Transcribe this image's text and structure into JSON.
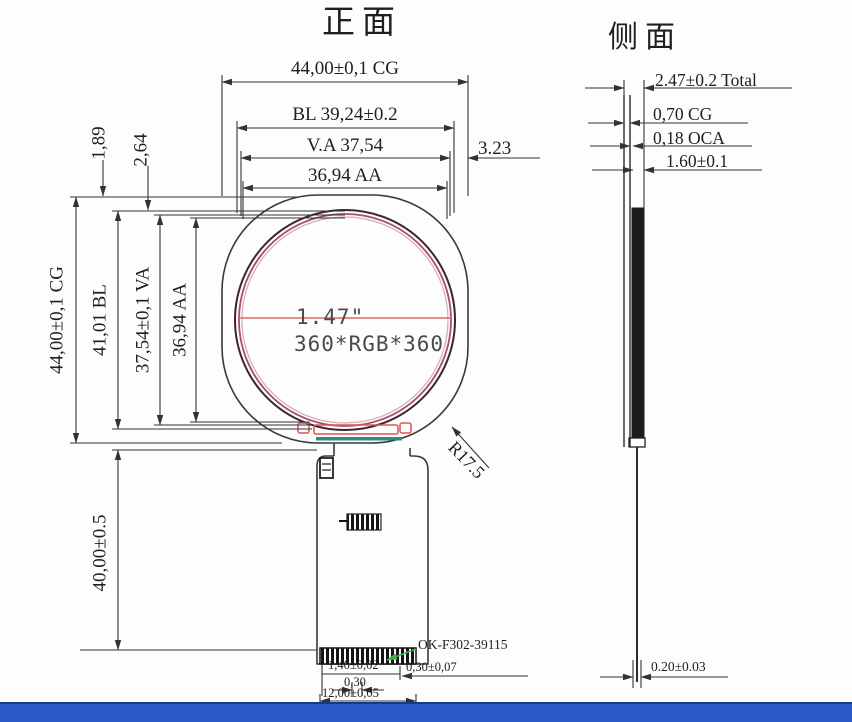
{
  "front": {
    "title": "正面",
    "dims_top": {
      "cg": "44,00±0,1 CG",
      "bl": "BL 39,24±0.2",
      "va": "V.A 37,54",
      "aa": "36,94 AA",
      "margin": "3.23"
    },
    "dims_left": {
      "cg": "44,00±0,1 CG",
      "bl": "41,01 BL",
      "va": "37,54±0,1 VA",
      "aa": "36,94 AA",
      "gap1": "1,89",
      "gap2": "2,64",
      "fpc_length": "40,00±0.5"
    },
    "corner_radius": "R17.5",
    "screen": {
      "size": "1.47\"",
      "resolution": "360*RGB*360"
    },
    "tail": {
      "part_number": "OK-F302-39115",
      "dim_pad": "1,40±0,02",
      "dim_pad_offset": "0,30±0,07",
      "dim_pitch": "0,30",
      "dim_width": "12,00±0,05"
    }
  },
  "side": {
    "title": "侧面",
    "dim_total": "2.47±0.2 Total",
    "dim_cg": "0,70 CG",
    "dim_oca": "0,18 OCA",
    "dim_module": "1.60±0.1",
    "dim_fpc": "0.20±0.03"
  },
  "colors": {
    "line": "#333333",
    "center_line_red": "#d96a6a",
    "ring_pink": "#a64e74",
    "seal_teal": "#2a8f86",
    "pad_red": "#e05555",
    "leader_green": "#3db54a",
    "footer_blue": "#2a58c6"
  }
}
